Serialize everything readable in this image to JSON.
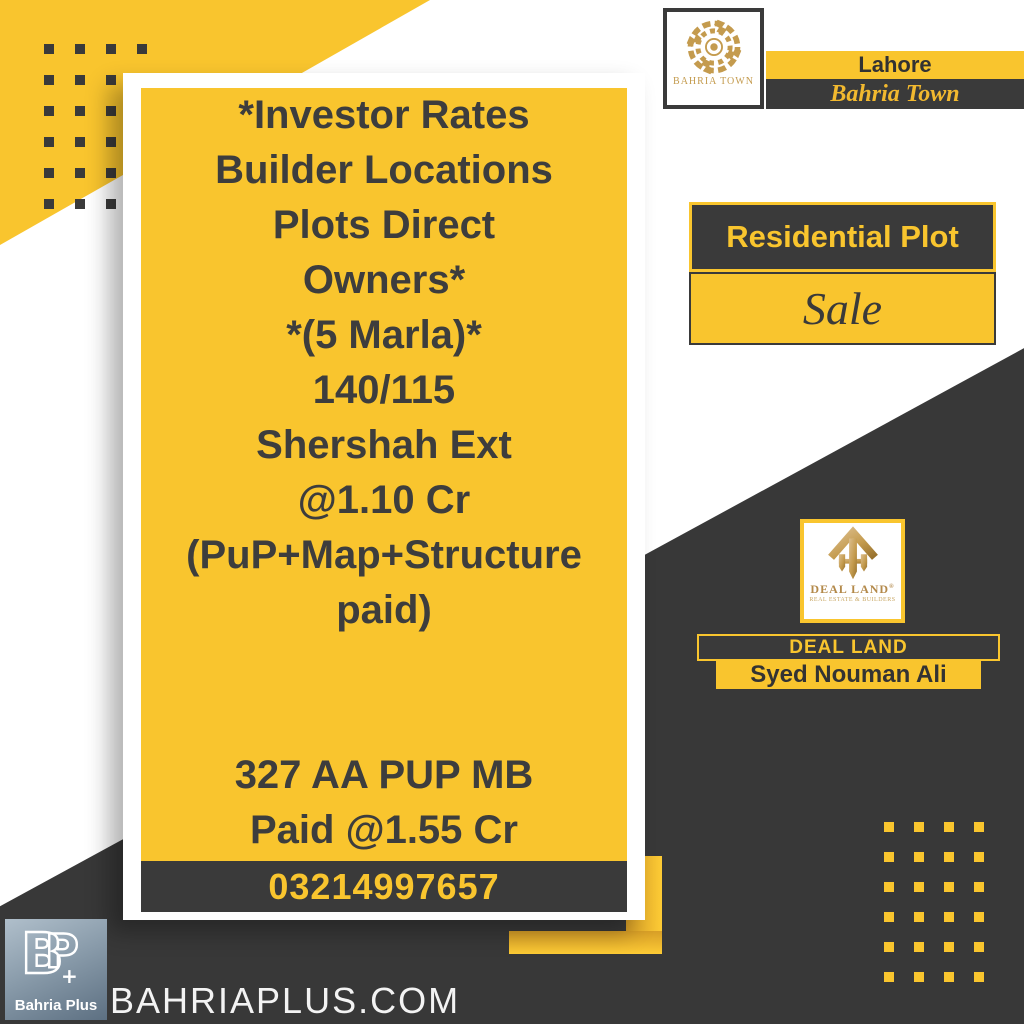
{
  "card": {
    "lines": [
      "*Investor Rates",
      "Builder Locations",
      "Plots Direct",
      "Owners*",
      "*(5 Marla)*",
      "140/115",
      "Shershah Ext",
      "@1.10 Cr",
      "(PuP+Map+Structure",
      "paid)",
      "",
      "",
      "327 AA PUP MB",
      "Paid @1.55 Cr"
    ],
    "phone": "03214997657"
  },
  "bahria_town": {
    "logo_text": "BAHRIA TOWN",
    "city": "Lahore",
    "name": "Bahria Town"
  },
  "listing": {
    "type": "Residential Plot",
    "status": "Sale"
  },
  "agent": {
    "logo_text": "DEAL LAND",
    "registered": "®",
    "company_tagline": "REAL ESTATE & BUILDERS",
    "company": "DEAL LAND",
    "name": "Syed Nouman Ali"
  },
  "footer": {
    "brand": "Bahria Plus",
    "website": "BAHRIAPLUS.COM"
  },
  "colors": {
    "yellow": "#F9C52E",
    "dark": "#3A3A3A",
    "gold": "#C49B4E",
    "card_text": "#3D3D3D"
  },
  "decor": {
    "dot_columns": 4,
    "dot_rows": 6
  }
}
